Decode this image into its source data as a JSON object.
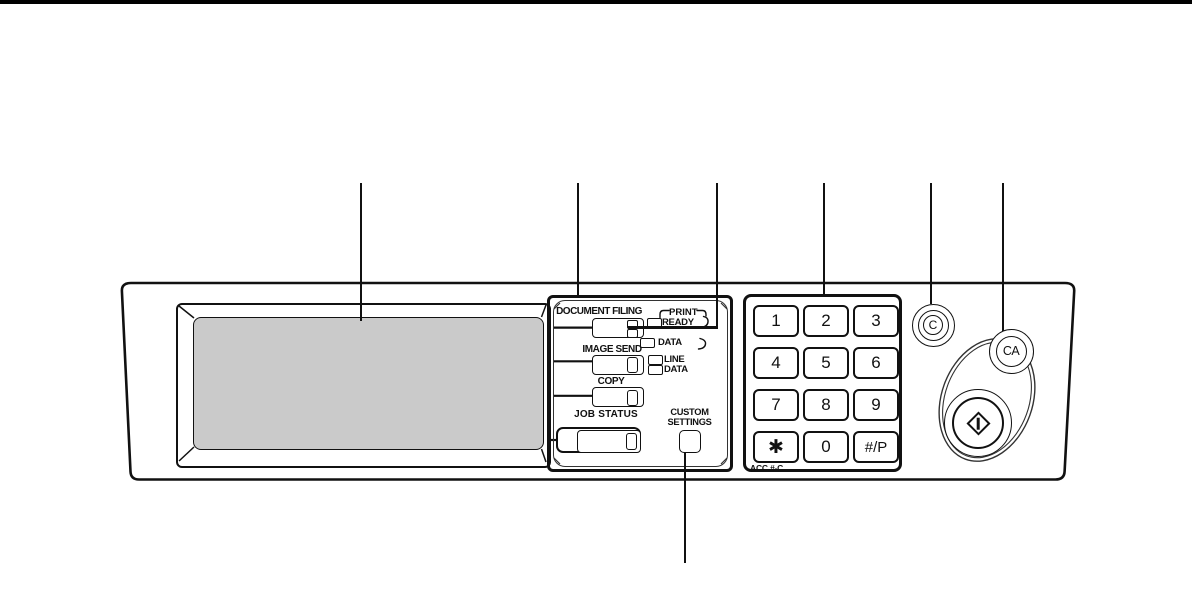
{
  "diagram": {
    "modes": {
      "document_filing": "DOCUMENT FILING",
      "image_send": "IMAGE SEND",
      "copy": "COPY",
      "job_status": "JOB STATUS",
      "custom_settings": "CUSTOM SETTINGS"
    },
    "indicators": {
      "print": "PRINT",
      "ready": "READY",
      "print_data": "DATA",
      "line": "LINE",
      "line_data": "DATA"
    },
    "keypad": {
      "keys": [
        "1",
        "2",
        "3",
        "4",
        "5",
        "6",
        "7",
        "8",
        "9",
        "✱",
        "0",
        "#/P"
      ],
      "acc_label": "ACC.#-C"
    },
    "buttons": {
      "clear": "C",
      "clear_all": "CA"
    },
    "icons": {
      "start": "diamond-start-icon",
      "touch_screen": "touch-screen-display"
    },
    "colors": {
      "line": "#111111",
      "screen_fill": "#cacaca"
    }
  }
}
